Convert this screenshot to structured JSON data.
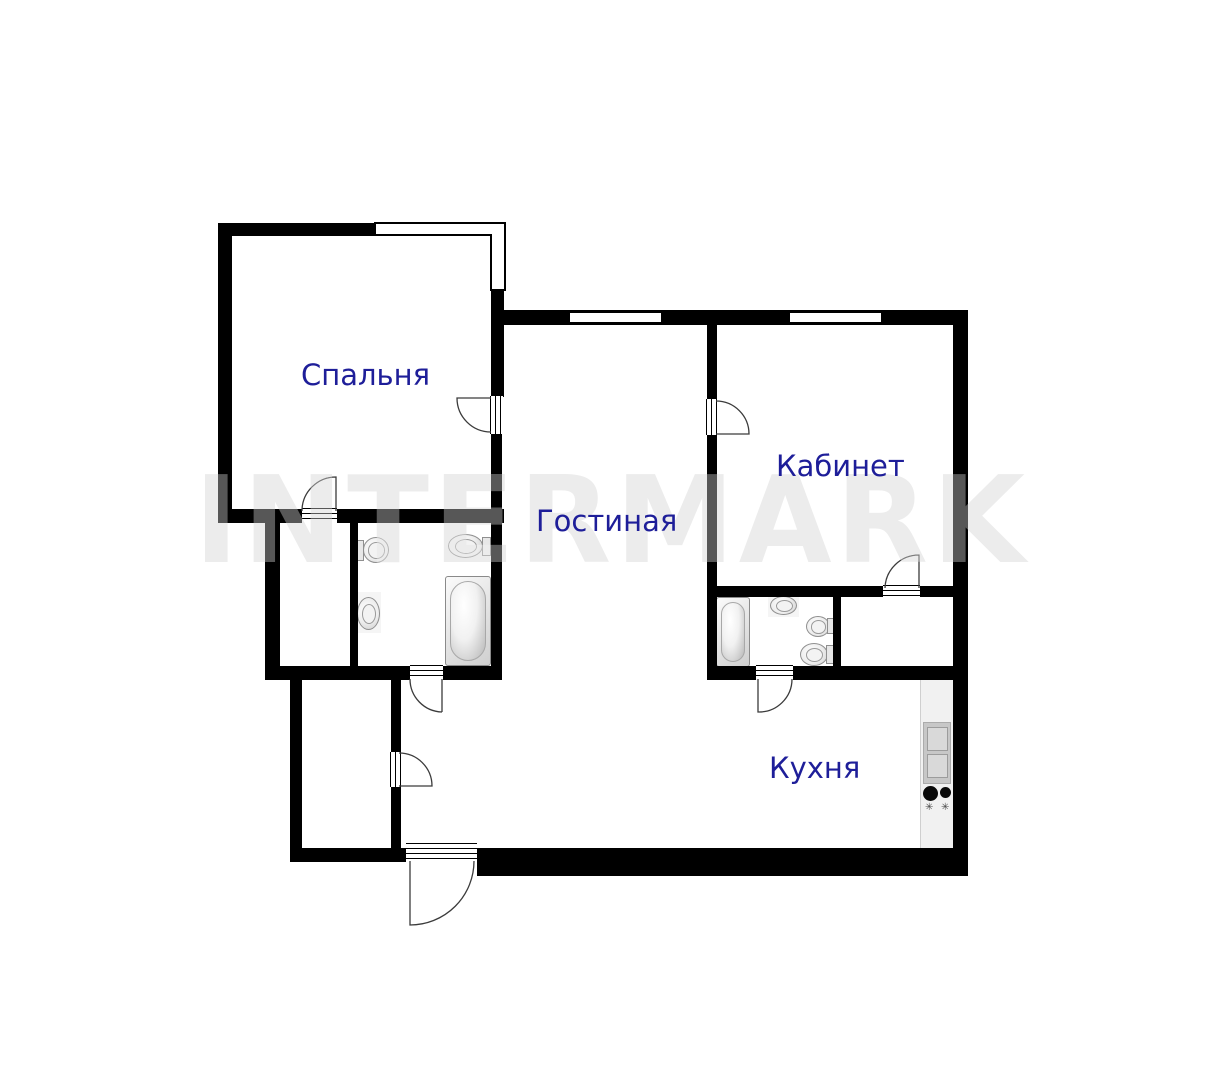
{
  "watermark": {
    "text": "INTERMARK"
  },
  "rooms": {
    "bedroom": {
      "label": "Спальня"
    },
    "living_room": {
      "label": "Гостиная"
    },
    "office": {
      "label": "Кабинет"
    },
    "kitchen": {
      "label": "Кухня"
    }
  },
  "icons": {
    "burner_star": "✳"
  },
  "colors": {
    "wall": "#000000",
    "room_label": "#1e1e99",
    "watermark": "#ececec",
    "fixture_outline": "#8f8f8f",
    "kitchen_counter": "#f1f1f1"
  },
  "fixtures": [
    "bathtub",
    "toilet",
    "bidet",
    "sink",
    "kitchen-sink",
    "stove-burners"
  ]
}
